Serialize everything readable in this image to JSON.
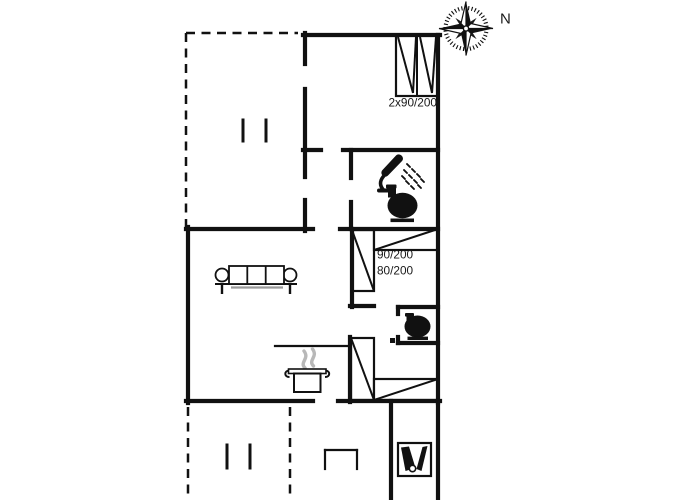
{
  "page": {
    "background": "#ffffff",
    "type": "holiday-house-floor-plan"
  },
  "colors": {
    "line": "#111111",
    "text": "#1a1a1a",
    "steam": "#b8b8b8",
    "sofa_shadow": "#9a9a9a",
    "background": "#ffffff"
  },
  "compass": {
    "label": "N"
  },
  "labels": {
    "double_bed": "2x90/200",
    "bed_90": "90/200",
    "bed_80": "80/200"
  },
  "icons": [
    "compass-rose-icon",
    "shower-icon",
    "toilet-icon",
    "toilet-icon",
    "sofa-icon",
    "cooking-pot-icon",
    "steam-icon",
    "utility-fixture-icon",
    "bed-symbol",
    "terrace-post-ticks"
  ],
  "floorplan": {
    "walls": [
      [
        303,
        35,
        440,
        35
      ],
      [
        438,
        35,
        438,
        403
      ],
      [
        305,
        33,
        305,
        64
      ],
      [
        305,
        89,
        305,
        177
      ],
      [
        305,
        200,
        305,
        231
      ],
      [
        303,
        150,
        321,
        150
      ],
      [
        343,
        150,
        438,
        150
      ],
      [
        351,
        150,
        351,
        178
      ],
      [
        351,
        202,
        351,
        229
      ],
      [
        186,
        229,
        313,
        229
      ],
      [
        340,
        229,
        438,
        229
      ],
      [
        188,
        227,
        188,
        403
      ],
      [
        186,
        401,
        313,
        401
      ],
      [
        338,
        401,
        440,
        401
      ],
      [
        352,
        229,
        352,
        307
      ],
      [
        350,
        306,
        374,
        306
      ],
      [
        398,
        307,
        438,
        307
      ],
      [
        398,
        307,
        398,
        314
      ],
      [
        398,
        343,
        438,
        343
      ],
      [
        398,
        337,
        398,
        343
      ],
      [
        350,
        337,
        350,
        402
      ],
      [
        391,
        401,
        391,
        500
      ],
      [
        438,
        401,
        438,
        500
      ]
    ],
    "dashed_walls": [
      [
        186,
        33,
        186,
        229
      ],
      [
        186,
        33,
        298,
        33
      ],
      [
        188,
        407,
        188,
        500
      ],
      [
        290,
        407,
        290,
        500
      ]
    ],
    "window_ticks": [
      [
        243,
        120,
        243,
        141
      ],
      [
        266,
        120,
        266,
        141
      ],
      [
        227,
        445,
        227,
        468
      ],
      [
        250,
        445,
        250,
        468
      ]
    ],
    "thin_lines": [
      [
        275,
        346,
        350,
        346
      ],
      [
        325,
        469,
        325,
        450
      ],
      [
        325,
        450,
        357,
        450
      ],
      [
        357,
        450,
        357,
        469
      ]
    ],
    "door_posts": [
      [
        390,
        338,
        5,
        5
      ]
    ],
    "beds": [
      {
        "name": "double-bed-2x90-200",
        "rect": [
          396,
          35,
          42,
          61
        ],
        "lines": [
          [
            417,
            35,
            417,
            96
          ],
          [
            398,
            37,
            413,
            93
          ],
          [
            416,
            37,
            413,
            93
          ],
          [
            420,
            37,
            432,
            93
          ],
          [
            436,
            37,
            432,
            93
          ]
        ]
      },
      {
        "name": "single-bed-90-200",
        "rect": [
          352,
          230,
          22,
          61
        ],
        "lines": [
          [
            352,
            230,
            374,
            291
          ]
        ]
      },
      {
        "name": "single-bed-80-200",
        "rect": [
          374,
          229,
          64,
          21
        ],
        "lines": [
          [
            374,
            250,
            438,
            229
          ]
        ]
      },
      {
        "name": "single-bed-vertical",
        "rect": [
          351,
          338,
          23,
          62
        ],
        "lines": [
          [
            351,
            338,
            374,
            400
          ]
        ]
      },
      {
        "name": "single-bed-horizontal",
        "rect": [
          374,
          379,
          64,
          21
        ],
        "lines": [
          [
            374,
            400,
            438,
            379
          ]
        ]
      }
    ]
  }
}
